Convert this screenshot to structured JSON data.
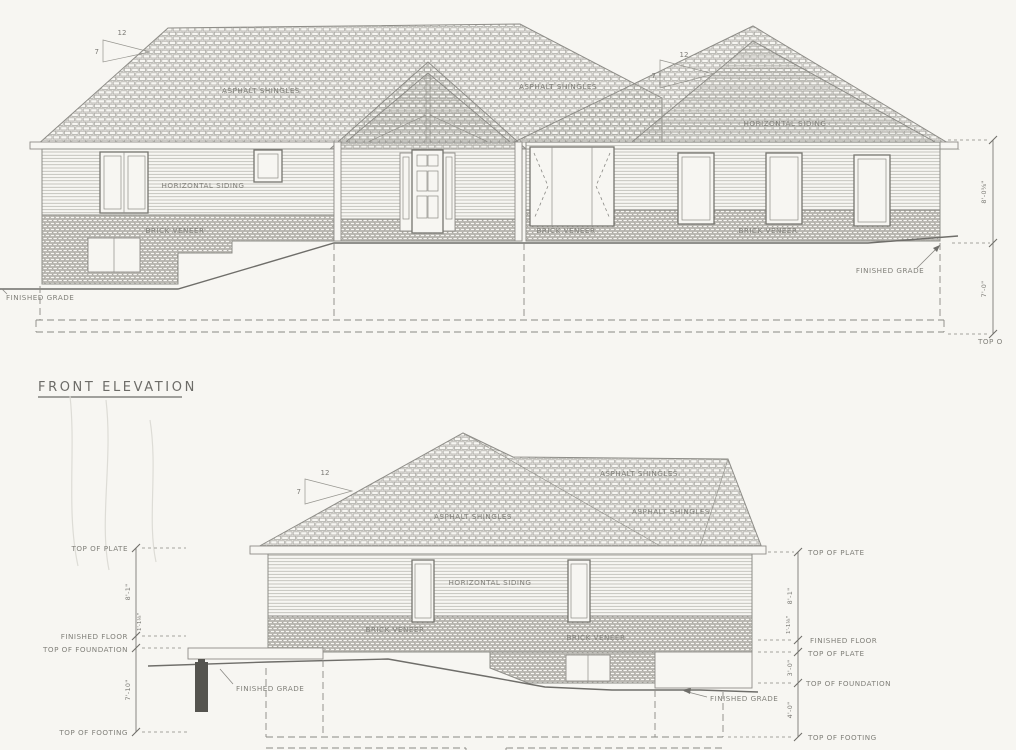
{
  "colors": {
    "paper": "#f7f6f2",
    "ink": "#8e8d88",
    "ink_dark": "#6f6e6a"
  },
  "front": {
    "title": "FRONT ELEVATION",
    "roof_label_left": "ASPHALT SHINGLES",
    "roof_label_right": "ASPHALT SHINGLES",
    "siding_label_wall": "HORIZONTAL SIDING",
    "siding_label_gable": "HORIZONTAL SIDING",
    "brick_label_left": "BRICK VENEER",
    "brick_label_center": "BRICK VENEER",
    "brick_label_right": "BRICK VENEER",
    "grade_label_left": "FINISHED GRADE",
    "grade_label_right": "FINISHED GRADE",
    "pitch_run": "12",
    "pitch_rise": "7",
    "dim_wall_height": "8'-0⅝\"",
    "dim_foundation_depth": "7'-0\"",
    "dim_bottom_clipped": "TOP O"
  },
  "side": {
    "roof_label_upper": "ASPHALT SHINGLES",
    "roof_label_left": "ASPHALT SHINGLES",
    "roof_label_right": "ASPHALT SHINGLES",
    "siding_label": "HORIZONTAL SIDING",
    "brick_label_left": "BRICK VENEER",
    "brick_label_right": "BRICK VENEER",
    "grade_label_left": "FINISHED GRADE",
    "grade_label_right": "FINISHED GRADE",
    "pitch_run": "12",
    "pitch_rise": "7",
    "left_dim": {
      "top_of_plate": "TOP OF PLATE",
      "finished_floor": "FINISHED FLOOR",
      "top_of_foundation": "TOP OF FOUNDATION",
      "top_of_footing": "TOP OF FOOTING",
      "plate_to_floor": "8'-1\"",
      "floor_to_foundation": "1'-1⅛\"",
      "foundation_to_footing": "7'-10\""
    },
    "right_dim": {
      "top_of_plate_upper": "TOP OF PLATE",
      "finished_floor": "FINISHED FLOOR",
      "top_of_plate_lower": "TOP OF PLATE",
      "top_of_foundation": "TOP OF FOUNDATION",
      "top_of_footing": "TOP OF FOOTING",
      "plate_to_floor": "8'-1\"",
      "floor_to_plate": "1'-1⅛\"",
      "plate_to_foundation": "3'-0\"",
      "foundation_to_footing": "4'-0\""
    }
  }
}
